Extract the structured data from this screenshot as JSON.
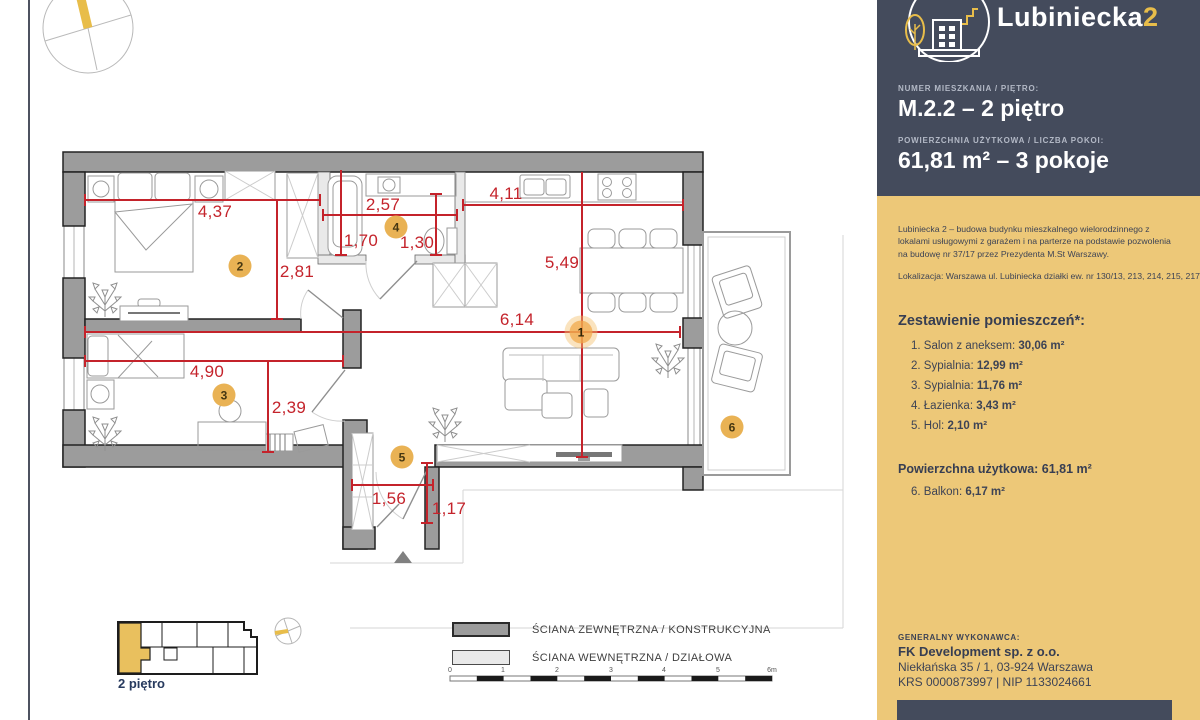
{
  "page": {
    "floor_label": "2 piętro"
  },
  "logo": {
    "name": "Lubiniecka",
    "suffix": "2"
  },
  "apartment": {
    "number_label": "NUMER MIESZKANIA / PIĘTRO:",
    "number_value": "M.2.2 – 2 piętro",
    "area_label": "POWIERZCHNIA UŻYTKOWA / LICZBA POKOI:",
    "area_value": "61,81 m² – 3 pokoje"
  },
  "description": {
    "paragraph": "Lubiniecka 2 – budowa budynku mieszkalnego wielorodzinnego z lokalami usługowymi z garażem i na parterze na podstawie pozwolenia na budowę nr 37/17 przez Prezydenta M.St Warszawy.",
    "location": "Lokalizacja: Warszawa ul. Lubiniecka działki ew. nr 130/13, 213, 214, 215, 217,"
  },
  "rooms": {
    "heading": "Zestawienie pomieszczeń*:",
    "items": [
      {
        "label": "1. Salon z aneksem: ",
        "area": "30,06 m²"
      },
      {
        "label": "2. Sypialnia: ",
        "area": "12,99 m²"
      },
      {
        "label": "3. Sypialnia: ",
        "area": "11,76 m²"
      },
      {
        "label": "4. Łazienka: ",
        "area": "3,43 m²"
      },
      {
        "label": "5. Hol: ",
        "area": "2,10 m²"
      }
    ],
    "total_label": "Powierzchna użytkowa: ",
    "total_value": "61,81 m²",
    "balcony_label": "6. Balkon: ",
    "balcony_value": "6,17 m²"
  },
  "contractor": {
    "heading": "GENERALNY WYKONAWCA:",
    "name": "FK Development sp. z o.o.",
    "address": "Niekłańska 35 / 1, 03-924 Warszawa",
    "ids": "KRS 0000873997 | NIP 1133024661"
  },
  "legend": {
    "external": "ŚCIANA ZEWNĘTRZNA / KONSTRUKCYJNA",
    "internal": "ŚCIANA WEWNĘTRZNA / DZIAŁOWA",
    "scale_ticks": [
      "0",
      "1",
      "2",
      "3",
      "4",
      "5",
      "6m"
    ]
  },
  "plan": {
    "dimensions": [
      "4,37",
      "2,57",
      "4,11",
      "1,70",
      "1,30",
      "2,81",
      "5,49",
      "6,14",
      "4,90",
      "2,39",
      "1,56",
      "1,17"
    ],
    "badges": [
      "1",
      "2",
      "3",
      "4",
      "5",
      "6"
    ]
  },
  "colors": {
    "accent_yellow": "#e8bd4a",
    "panel_dark": "#444b5c",
    "panel_yellow": "#edc878",
    "dimension_red": "#c4232b",
    "wall_external": "#9c9c9c",
    "wall_internal": "#e9e9e9"
  }
}
